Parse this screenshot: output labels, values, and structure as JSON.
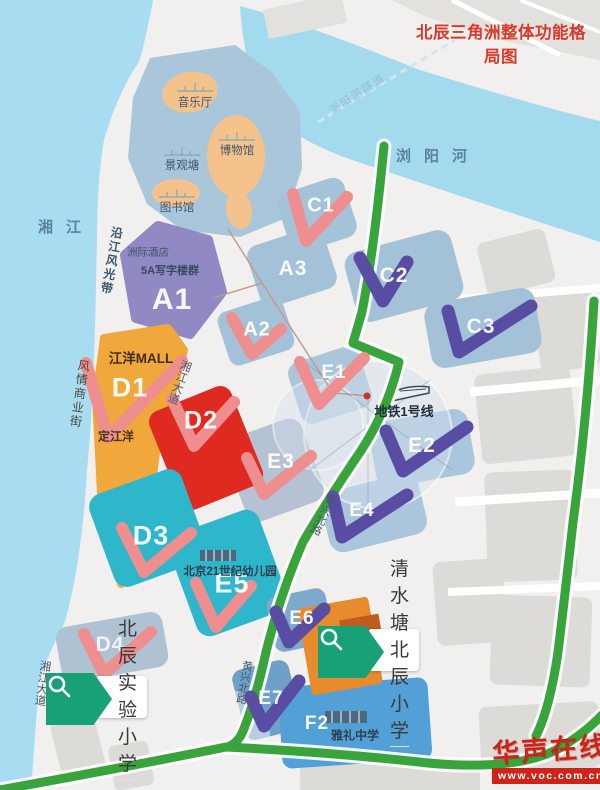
{
  "title": "北辰三角洲整体功能格局图",
  "water": {
    "xiang_river": "湘江",
    "liuyang_river": "浏阳河",
    "tunnel": "浏阳河隧道"
  },
  "roads": {
    "riverside_belt": "沿江风光带",
    "commercial_street": "风情商业街",
    "xiangjiang_avenue": "湘江大道",
    "huangxing_north_road": "黄兴北路"
  },
  "landmarks": {
    "concert_hall": "音乐厅",
    "museum": "博物馆",
    "scenic_pond": "景观塘",
    "library": "图书馆",
    "hotel": "洲际酒店",
    "office_cluster": "5A写字楼群",
    "mall": "江洋MALL",
    "dingjiangyang": "定江洋",
    "kindergarten": "北京21世纪幼儿园",
    "middle_school": "雅礼中学"
  },
  "metro": {
    "line1": "地铁1号线"
  },
  "zones": [
    {
      "id": "A1",
      "label": "A1"
    },
    {
      "id": "A2",
      "label": "A2"
    },
    {
      "id": "A3",
      "label": "A3"
    },
    {
      "id": "C1",
      "label": "C1"
    },
    {
      "id": "C2",
      "label": "C2"
    },
    {
      "id": "C3",
      "label": "C3"
    },
    {
      "id": "D1",
      "label": "D1"
    },
    {
      "id": "D2",
      "label": "D2"
    },
    {
      "id": "D3",
      "label": "D3"
    },
    {
      "id": "D4",
      "label": "D4"
    },
    {
      "id": "E1",
      "label": "E1"
    },
    {
      "id": "E2",
      "label": "E2"
    },
    {
      "id": "E3",
      "label": "E3"
    },
    {
      "id": "E4",
      "label": "E4"
    },
    {
      "id": "E5",
      "label": "E5"
    },
    {
      "id": "E6",
      "label": "E6"
    },
    {
      "id": "E7",
      "label": "E7"
    },
    {
      "id": "F2",
      "label": "F2"
    }
  ],
  "checkmarks": {
    "pink_zones": [
      "C1",
      "A2",
      "E1",
      "D1",
      "D2",
      "E3",
      "D3",
      "E5",
      "D4"
    ],
    "purple_zones": [
      "C2",
      "C3",
      "E2",
      "E4",
      "E6",
      "E7"
    ]
  },
  "search_tags": [
    {
      "label": "清水塘北辰小学"
    },
    {
      "label": "北辰实验小学"
    }
  ],
  "watermark": {
    "brand": "华声在线",
    "url": "www.voc.com.cn"
  },
  "colors": {
    "green_route": "#3aa43c",
    "pink_check": "#ef8e8e",
    "purple_check": "#584da3",
    "title_red": "#d93a2c",
    "tag_green": "#18a076",
    "water_blue": "#a8dcf0"
  }
}
